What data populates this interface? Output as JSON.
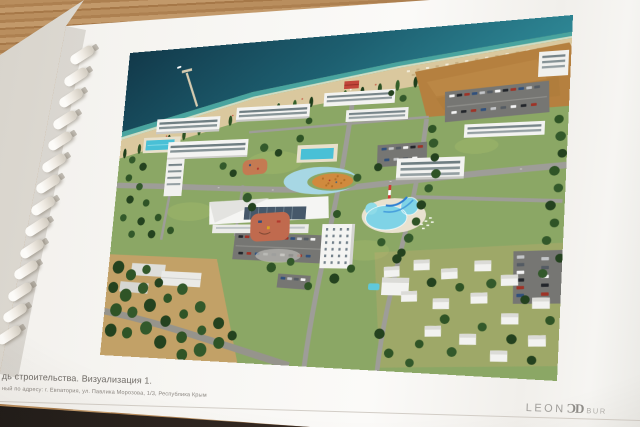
{
  "caption": {
    "line1": "дь строительства. Визуализация 1.",
    "line2": "ный по адресу: г. Евпатория, ул. Павлика Морозова, 1/3, Республика Крым"
  },
  "logo": {
    "name_left": "LEON",
    "monogram": "ƆD",
    "name_right_partial": "BUR"
  },
  "colors": {
    "wood": "#b98e5e",
    "page": "#f8f7f4",
    "page_stack": "#e5e1da",
    "cover_dark": "#2a211d",
    "sea_deep": "#12394a",
    "sea_shallow": "#2e8795",
    "surf": "#3da3a9",
    "sand": "#dac89e",
    "lawn": "#8ba765",
    "tree_dark": "#24421f",
    "asphalt": "#9e9d98",
    "building_white": "#f3f3f1",
    "window_strip": "#57696f",
    "pool_blue": "#49c0d6",
    "aqua_pool": "#7fd3e6",
    "dirt_field": "#b5803f",
    "plaza_orange": "#d08a3e",
    "playground_terracotta": "#c06a4e",
    "accent_red": "#c2453a",
    "caption_text": "#6f6b66",
    "logo_gray": "#a19f9b"
  }
}
